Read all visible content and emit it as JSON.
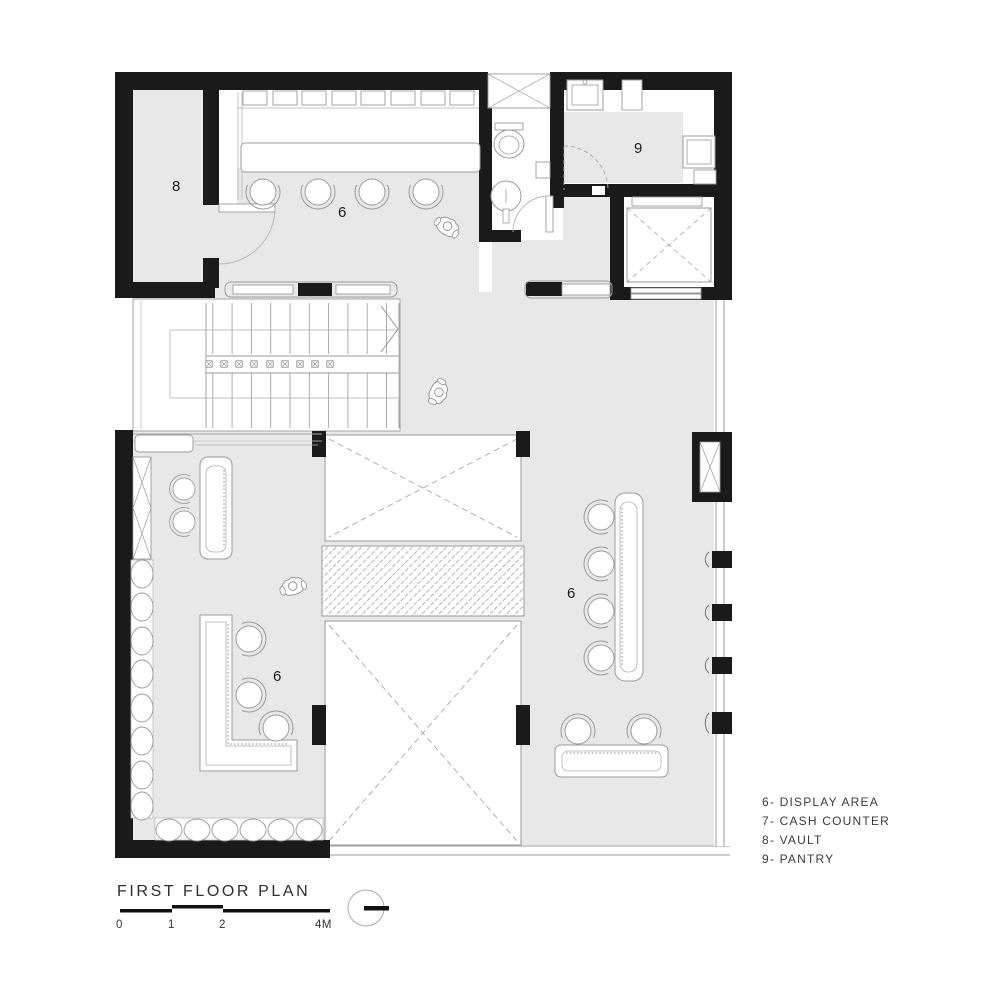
{
  "plan": {
    "title": "FIRST FLOOR PLAN",
    "scale": {
      "labels": [
        "0",
        "1",
        "2",
        "4M"
      ]
    },
    "legend": [
      {
        "label": "6- DISPLAY AREA"
      },
      {
        "label": "7- CASH COUNTER"
      },
      {
        "label": "8- VAULT"
      },
      {
        "label": "9- PANTRY"
      }
    ],
    "room_labels": {
      "vault": "8",
      "display_top": "6",
      "pantry": "9",
      "display_left": "6",
      "display_right": "6"
    },
    "colors": {
      "wall": "#1a1a1a",
      "floor": "#e8e8e9",
      "line": "#9b9b9b",
      "paper": "#ffffff"
    }
  }
}
